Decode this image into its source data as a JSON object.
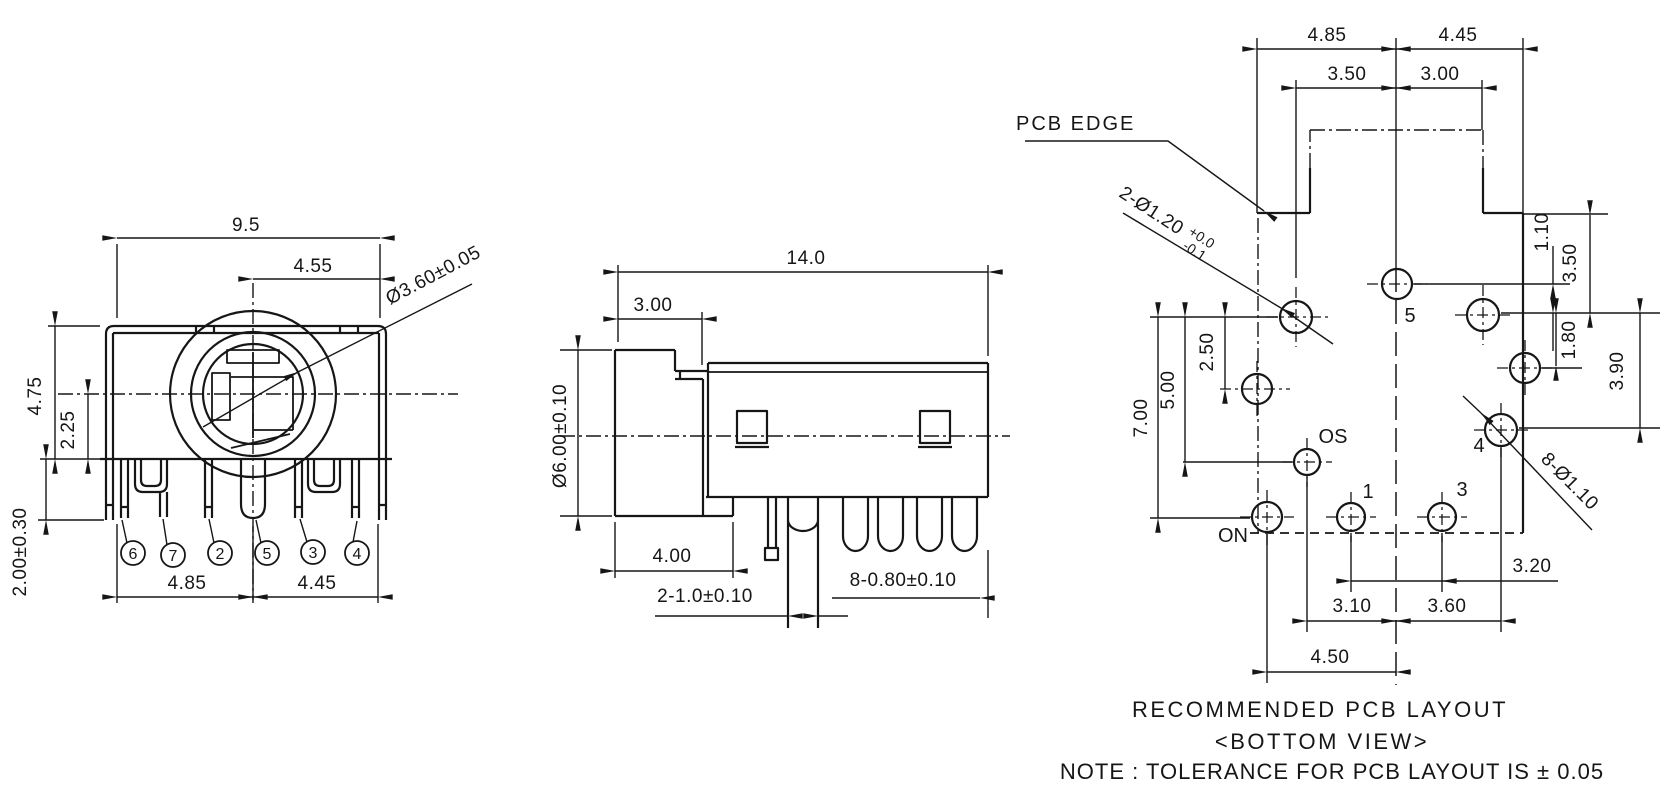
{
  "front_view": {
    "width": "9.5",
    "center_to_right": "4.55",
    "barrel": "Ø3.60±0.05",
    "height": "4.75",
    "center_height": "2.25",
    "leg_length": "2.00±0.30",
    "pitch_left": "4.85",
    "pitch_right": "4.45",
    "pins": {
      "p6": "6",
      "p7": "7",
      "p2": "2",
      "p5": "5",
      "p3": "3",
      "p4": "4"
    }
  },
  "side_view": {
    "length": "14.0",
    "barrel_length": "3.00",
    "barrel_dia": "Ø6.00±0.10",
    "base": "4.00",
    "center_pins": "2-1.0±0.10",
    "legs": "8-0.80±0.10"
  },
  "pcb": {
    "edge_label": "PCB EDGE",
    "mount": "2-Ø1.20",
    "mount_plus": "+0.0",
    "mount_minus": "-0.1",
    "pin_holes": "8-Ø1.10",
    "top": {
      "left": "4.85",
      "right": "4.45",
      "notch_left": "3.50",
      "notch_right": "3.00"
    },
    "right": {
      "r1": "1.10",
      "r2": "3.50",
      "r3": "1.80",
      "r4": "3.90"
    },
    "left": {
      "l1": "7.00",
      "l2": "5.00",
      "l3": "2.50"
    },
    "bottom": {
      "b1": "3.20",
      "b2": "3.10",
      "b3": "3.60",
      "b4": "4.50"
    },
    "holes": {
      "h5": "5",
      "os": "OS",
      "on": "ON",
      "h1": "1",
      "h3": "3",
      "h4": "4"
    }
  },
  "captions": {
    "title": "RECOMMENDED PCB LAYOUT",
    "subtitle": "<BOTTOM VIEW>",
    "note": "NOTE : TOLERANCE FOR PCB LAYOUT IS ± 0.05"
  }
}
